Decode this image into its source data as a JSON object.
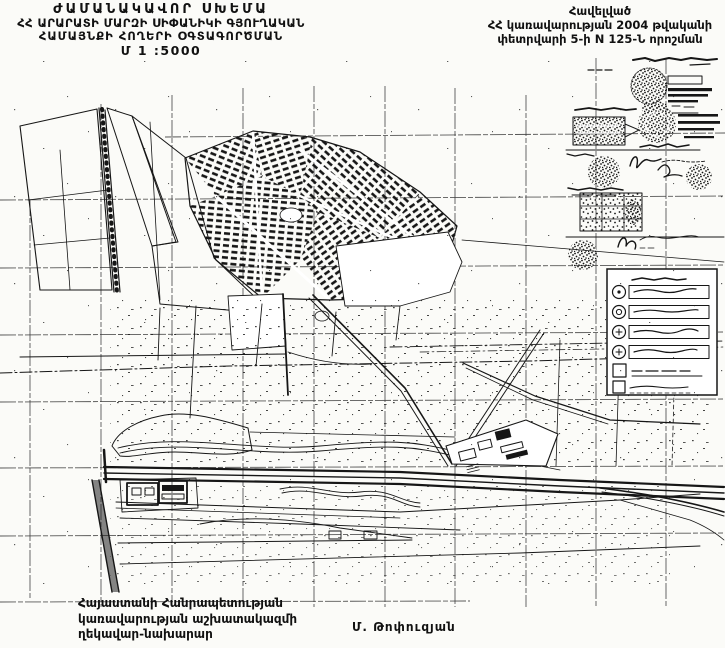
{
  "colors": {
    "paper": "#fbfbf8",
    "ink": "#161616",
    "grid": "#3a3a3a"
  },
  "title_block": {
    "line1": "ԺԱՄԱՆԱԿԱՎՈՐ ՍԽԵՄԱ",
    "line2": "ՀՀ ԱՐԱՐԱՏԻ ՄԱՐԶԻ ՍԻՓԱՆԻԿԻ ԳՅՈՒՂԱԿԱՆ",
    "line3": "ՀԱՄԱՅՆՔԻ ՀՈՂԵՐԻ ՕԳՏԱԳՈՐԾՄԱՆ",
    "line4": "Մ 1 :5000"
  },
  "annex_block": {
    "line1": "Հավելված",
    "line2": "ՀՀ կառավարության 2004 թվականի",
    "line3": "փետրվարի 5-ի N 125-Ն որոշման"
  },
  "footer": {
    "line1": "Հայաստանի Հանրապետության",
    "line2": "կառավարության աշխատակազմի",
    "line3": "ղեկավար-նախարար",
    "signatory": "Մ. Թոփուզյան"
  }
}
